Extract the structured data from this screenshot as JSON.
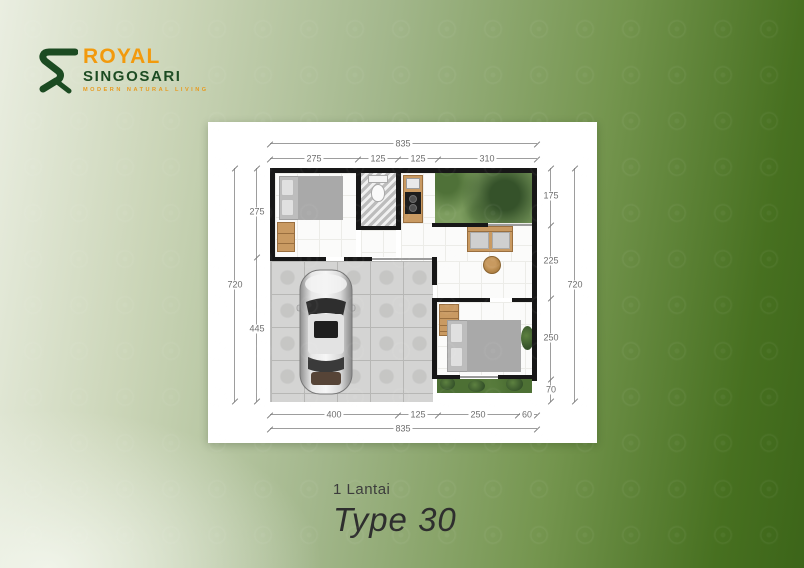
{
  "logo": {
    "monogram": "R",
    "brand": "ROYAL",
    "sub": "SINGOSARI",
    "tagline": "MODERN NATURAL LIVING"
  },
  "floorplan": {
    "dim_top_total": "835",
    "dim_top_segments": [
      "275",
      "125",
      "125",
      "310"
    ],
    "dim_left_total": "720",
    "dim_left_segments": [
      "275",
      "445"
    ],
    "dim_right_segments": [
      "175",
      "225",
      "250",
      "70"
    ],
    "dim_right_total": "720",
    "dim_bottom_segments": [
      "400",
      "125",
      "250",
      "60"
    ],
    "dim_bottom_total": "835"
  },
  "caption": {
    "floors": "1 Lantai",
    "type": "Type 30"
  },
  "colors": {
    "brand_orange": "#f29a0d",
    "brand_green": "#1c4b22",
    "bg_dark_green": "#3c6519"
  }
}
